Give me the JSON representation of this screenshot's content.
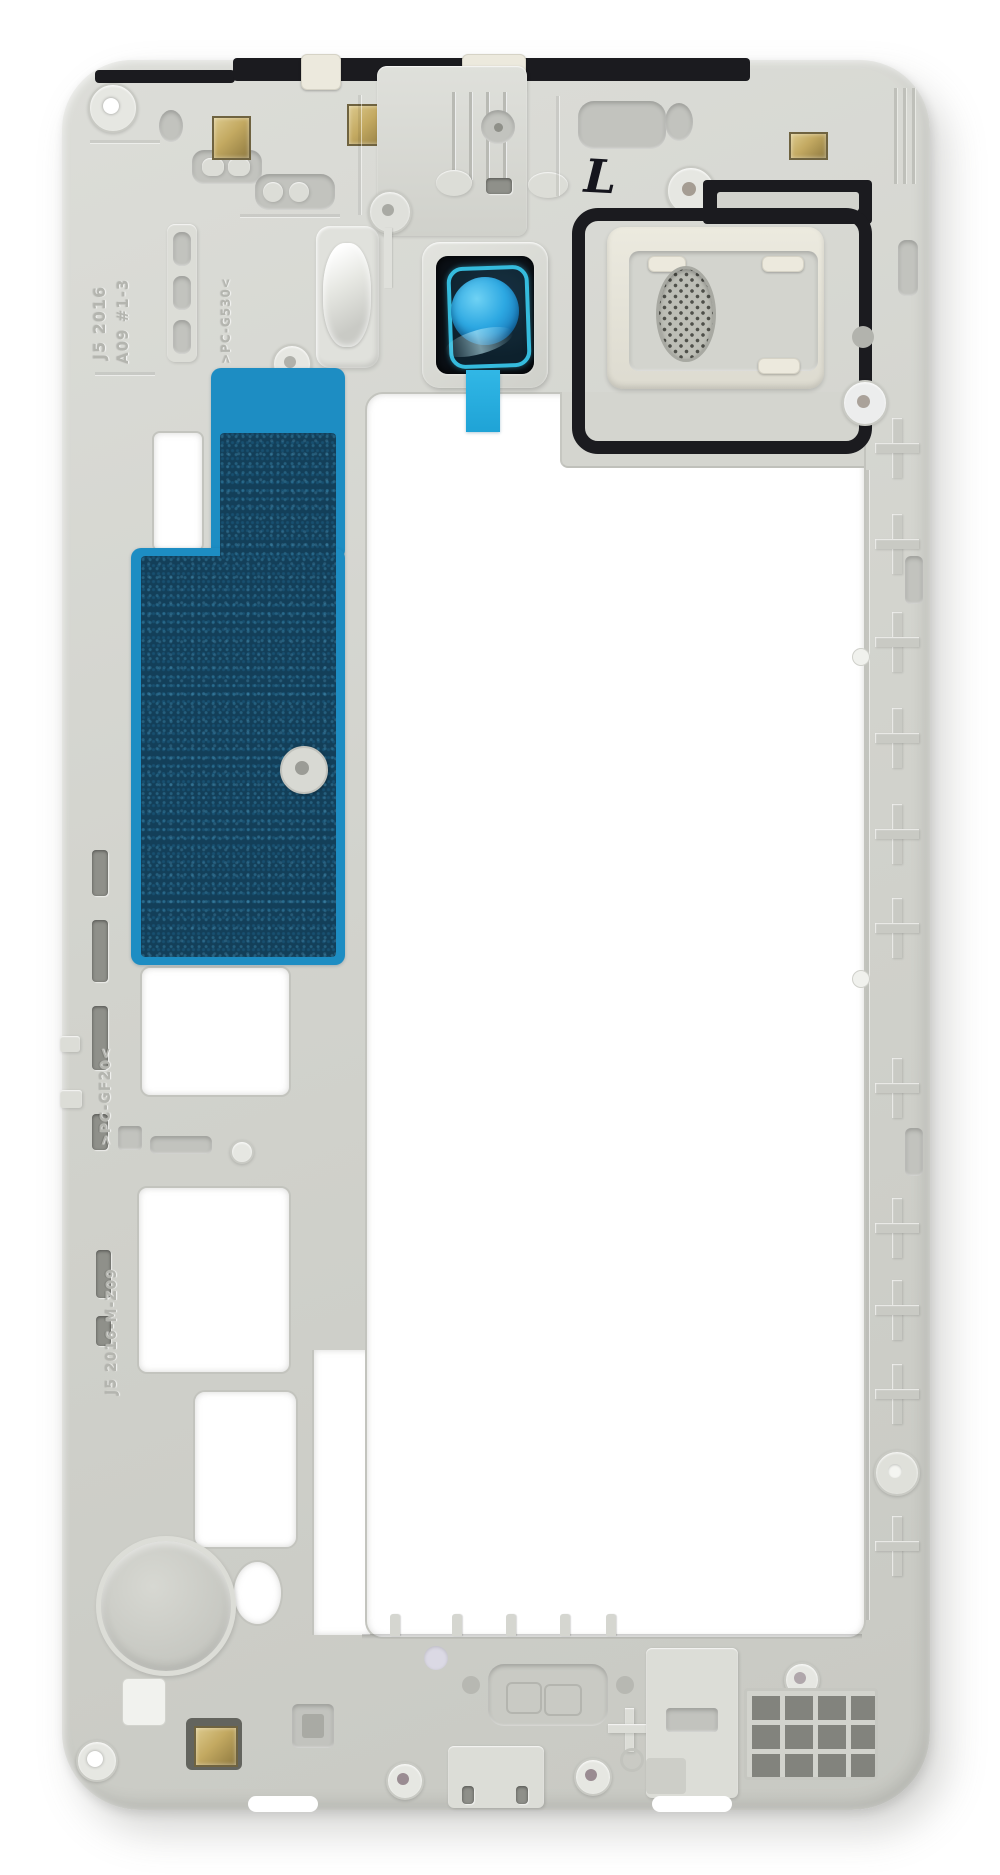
{
  "scene": {
    "description": "Rear mid-frame chassis of a white smartphone (inner side facing viewer) photographed on a white background",
    "background_color": "#ffffff"
  },
  "part": {
    "type": "smartphone mid-frame housing",
    "orientation": "portrait"
  },
  "markings": {
    "model_line1": "J5 2016",
    "model_line2": "A09 #1-3",
    "material_top": ">PC-G530<",
    "material_left": ">PC-GF20<",
    "mold_code": "J5 2016-M-Z09",
    "handwritten_mark": "L"
  },
  "colors": {
    "plastic_base": "#d2d3cd",
    "plastic_highlight": "#e9eae6",
    "plastic_shadow": "#aaaba6",
    "recess": "#c2c3be",
    "slot_dark": "#8f908a",
    "gasket_black": "#1b1b1f",
    "camera_window": "#0b1016",
    "camera_ring_cyan": "#35bbdd",
    "camera_lens_blue": "#2da8e2",
    "adhesive_border_blue": "#1d8dc3",
    "adhesive_fill_teal": "#133f59",
    "mesh_silver": "#bdbeb6",
    "contact_gold": "#c3a961",
    "cream_tab": "#ece9dd",
    "ink_mark": "#15151d"
  }
}
